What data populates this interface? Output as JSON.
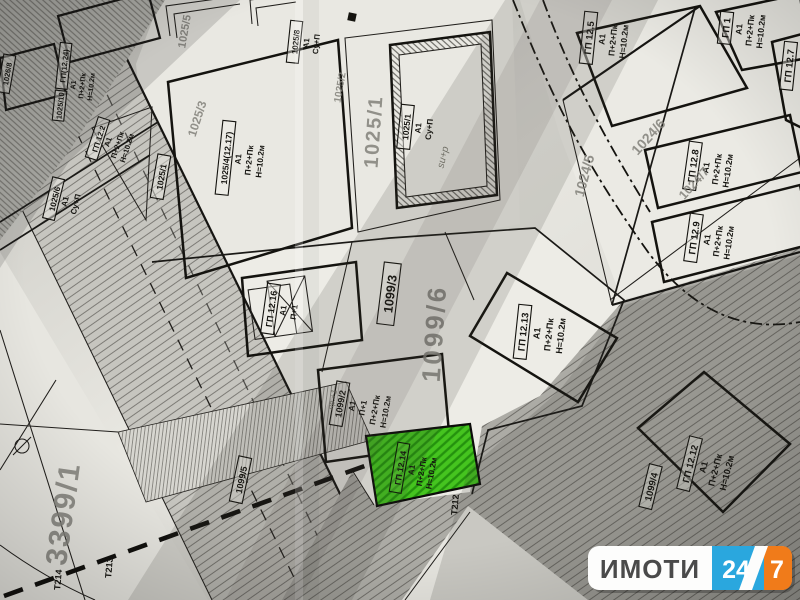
{
  "map": {
    "plots": {
      "gp12_5": {
        "id": "ГП 12.5",
        "use": "А1",
        "floors": "П+2+Пк",
        "height": "Н=10.2м"
      },
      "gp1": {
        "id": "ГП 1",
        "use": "А1",
        "floors": "П+2+Пк",
        "height": "Н=10.2м"
      },
      "gp12_7": {
        "id": "ГП 12.7"
      },
      "gp12_8": {
        "id": "ГП 12.8",
        "use": "А1",
        "floors": "П+2+Пк",
        "height": "Н=10.2м"
      },
      "gp12_9": {
        "id": "ГП 12.9",
        "use": "А1",
        "floors": "П+2+Пк",
        "height": "Н=10.2м"
      },
      "gp12_12": {
        "id": "ГП 12.12",
        "use": "А1",
        "floors": "П+2+Пк",
        "height": "Н=10.2м"
      },
      "gp12_13": {
        "id": "ГП 12.13",
        "use": "А1",
        "floors": "П+2+Пк",
        "height": "Н=10.2м"
      },
      "gp12_14": {
        "id": "ГП 12.14",
        "use": "А1",
        "floors": "П+2+Пк",
        "height": "Н=10.2м"
      },
      "gp12_16": {
        "id": "ГП 12.16",
        "use": "А1",
        "floors": "П+1"
      },
      "gp12_2": {
        "id": "ГП 12.2",
        "use": "А1",
        "floors": "П+2+Пк",
        "height": "Н=10.2м"
      },
      "gp12_24": {
        "id": "ГП(12.24)",
        "parcel": "1025/10",
        "use": "А1",
        "floors": "П+2+Пк",
        "height": "Н=10.2м"
      },
      "p1025_4": {
        "id": "1025/4(12.17)",
        "use": "А1",
        "floors": "П+2+Пк",
        "height": "Н=10.2м"
      },
      "p1025_6": {
        "id": "1025/6",
        "use": "А1",
        "floors": "Су+П"
      },
      "p1025_8": {
        "id": "1025/8",
        "use": "А1",
        "floors": "Су+П"
      },
      "p1025_1_building": {
        "id": "1025/1",
        "use": "А1",
        "floors": "Су+П"
      },
      "p1025_1_road": {
        "id": "1025/1"
      },
      "p1026_8": {
        "id": "1026/8"
      },
      "p1099_2": {
        "id": "1099/2",
        "use": "А1",
        "floors": "П+1",
        "floors2": "П+2+Пк",
        "height": "Н=10.2м"
      },
      "p1099_3": {
        "id": "1099/3"
      },
      "p1099_4": {
        "id": "1099/4"
      },
      "p1099_5": {
        "id": "1099/5"
      }
    },
    "parcel_numbers": {
      "g1025_5": "1025/5",
      "g1025_3": "1025/3",
      "g1025_2": "1025/2",
      "g1025_1": "1025/1",
      "g1024_5": "1024/5",
      "g1024_6": "1024/6",
      "g1024_7": "1024/7",
      "g1099_6": "1099/6",
      "g3399_1": "3399/1"
    },
    "survey_points": {
      "t212": "Т212",
      "t213": "Т213",
      "t214": "Т214"
    },
    "handwriting": {
      "note_su_p": "su+p",
      "note_pr_1": "пр.+1"
    }
  },
  "watermark": {
    "brand": "ИМОТИ",
    "number": "24",
    "seven": "7"
  },
  "colors": {
    "highlight_green": "#45c41f",
    "logo_blue": "#2aa7de",
    "logo_orange": "#f07b1a",
    "logo_text": "#4a4a4a",
    "paper": "#e6e5df",
    "ink": "#161512",
    "faded_ink": "#82817a"
  }
}
